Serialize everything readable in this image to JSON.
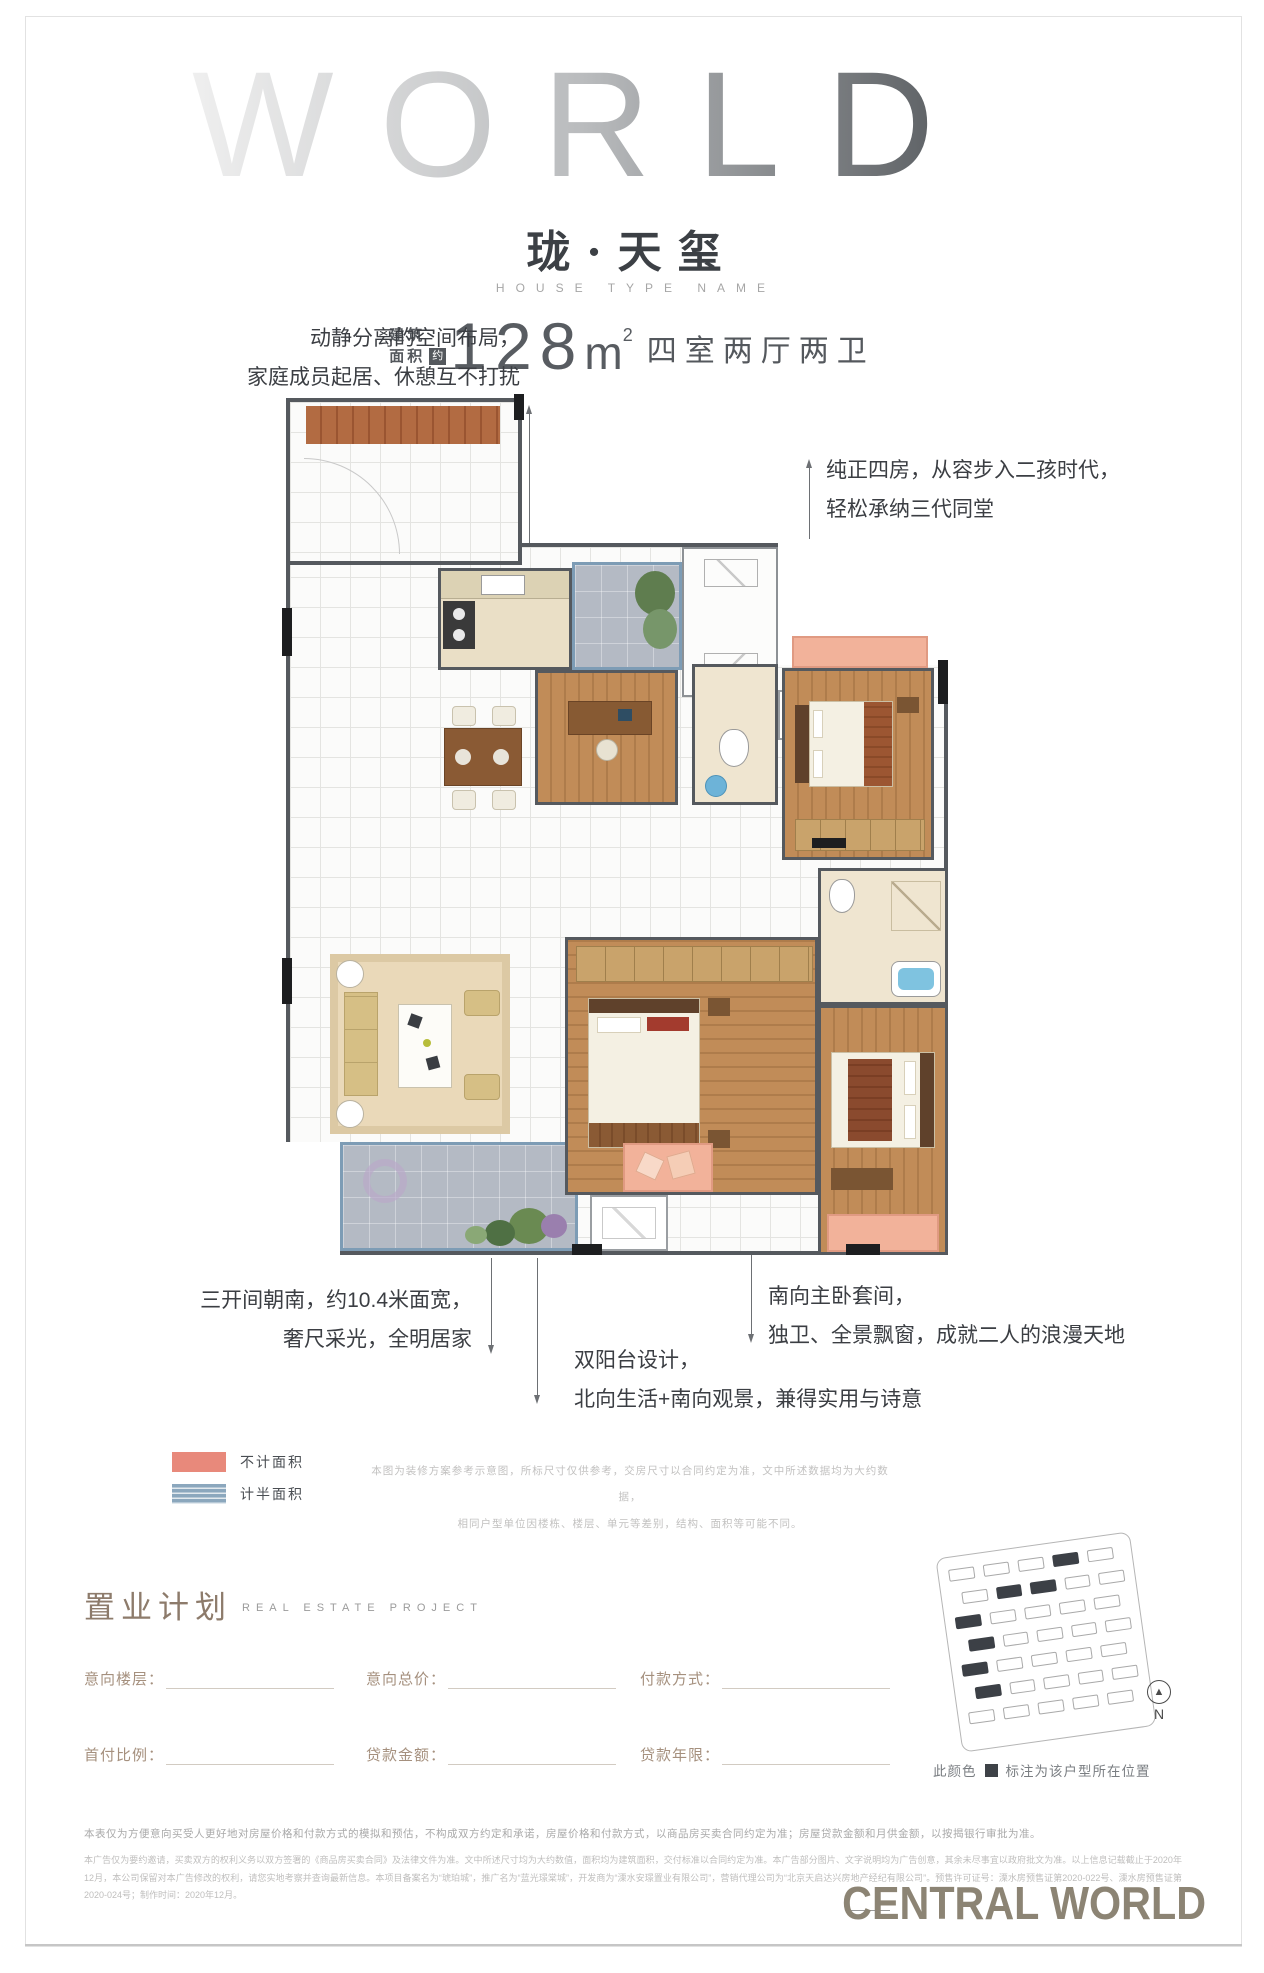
{
  "header": {
    "brand": "WORLD",
    "title": "珑·天玺",
    "subtitle": "HOUSE TYPE NAME",
    "area_label_top": "建筑",
    "area_label_bottom": "面积",
    "area_approx": "约",
    "area_value": "128",
    "area_unit": "m",
    "area_unit_sup": "2",
    "rooms": "四室两厅两卫"
  },
  "annotations": {
    "north_layout_l1": "动静分离的空间布局，",
    "north_layout_l2": "家庭成员起居、休憩互不打扰",
    "four_rooms_l1": "纯正四房，从容步入二孩时代，",
    "four_rooms_l2": "轻松承纳三代同堂",
    "south_bays_l1": "三开间朝南，约10.4米面宽，",
    "south_bays_l2": "奢尺采光，全明居家",
    "double_balcony_l1": "双阳台设计，",
    "double_balcony_l2": "北向生活+南向观景，兼得实用与诗意",
    "master_suite_l1": "南向主卧套间，",
    "master_suite_l2": "独卫、全景飘窗，成就二人的浪漫天地"
  },
  "legend": {
    "items": [
      {
        "label": "不计面积",
        "color": "#e8897b"
      },
      {
        "label": "计半面积",
        "color": "#8ba7bd"
      }
    ]
  },
  "plan_note": {
    "line1": "本图为装修方案参考示意图，所标尺寸仅供参考，交房尺寸以合同约定为准，文中所述数据均为大约数据，",
    "line2": "相同户型单位因楼栋、楼层、单元等差别，结构、面积等可能不同。"
  },
  "project": {
    "title": "置业计划",
    "subtitle": "REAL ESTATE PROJECT",
    "fields": [
      {
        "label": "意向楼层："
      },
      {
        "label": "意向总价："
      },
      {
        "label": "付款方式："
      },
      {
        "label": "首付比例："
      },
      {
        "label": "贷款金额："
      },
      {
        "label": "贷款年限："
      }
    ]
  },
  "sitemap": {
    "rows": 7,
    "cols": 5,
    "dark": [
      "0-3",
      "1-1",
      "1-2",
      "2-0",
      "3-0",
      "4-0",
      "5-0"
    ],
    "compass": "N",
    "caption_prefix": "此颜色",
    "caption_suffix": "标注为该户型所在位置"
  },
  "footer": {
    "line1": "本表仅为方便意向买受人更好地对房屋价格和付款方式的模拟和预估，不构成双方约定和承诺，房屋价格和付款方式，以商品房买卖合同约定为准；房屋贷款金额和月供金额，以按揭银行审批为准。",
    "fine_print": "本广告仅为要约邀请，买卖双方的权利义务以双方签署的《商品房买卖合同》及法律文件为准。文中所述尺寸均为大约数值，面积均为建筑面积，交付标准以合同约定为准。本广告部分图片、文字说明均为广告创意，其余未尽事宜以政府批文为准。以上信息记载截止于2020年12月，本公司保留对本广告修改的权利，请您实地考察并查询最新信息。本项目备案名为“琥珀城”，推广名为“蓝光璟棠城”，开发商为“溧水安璟置业有限公司”，营销代理公司为“北京天启达兴房地产经纪有限公司”。预售许可证号：溧水房预售证第2020-022号、溧水房预售证第2020-024号；制作时间：2020年12月。",
    "logo": "CENTRAL WORLD"
  }
}
